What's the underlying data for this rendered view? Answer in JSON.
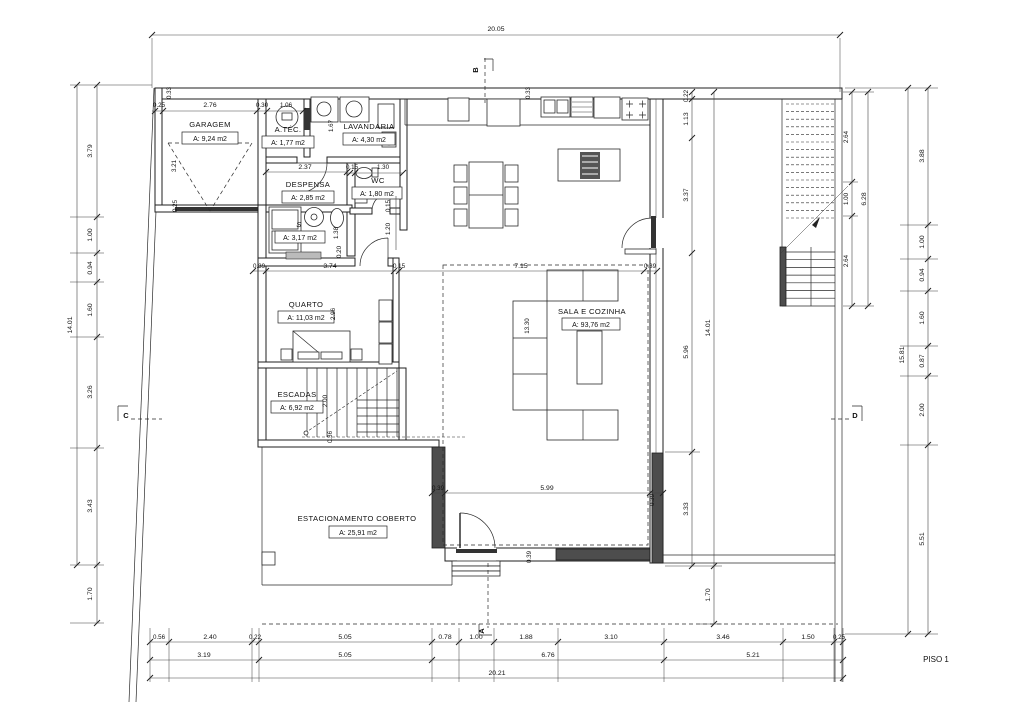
{
  "title": "PISO 1",
  "plan": {
    "rooms": {
      "garagem": {
        "name": "GARAGEM",
        "area": "A: 9,24 m2"
      },
      "atec": {
        "name": "A.TÉC.",
        "area": "A: 1,77 m2"
      },
      "lavandaria": {
        "name": "LAVANDARIA",
        "area": "A: 4,30 m2"
      },
      "despensa": {
        "name": "DESPENSA",
        "area": "A: 2,85 m2"
      },
      "wc": {
        "name": "WC",
        "area": "A: 1,80 m2"
      },
      "sanit": {
        "name": "S",
        "area": "A: 3,17 m2"
      },
      "quarto": {
        "name": "QUARTO",
        "area": "A: 11,03 m2"
      },
      "escadas": {
        "name": "ESCADAS",
        "area": "A: 6,92 m2"
      },
      "sala": {
        "name": "SALA E COZINHA",
        "area": "A: 93,76 m2"
      },
      "estacionamento": {
        "name": "ESTACIONAMENTO COBERTO",
        "area": "A: 25,91 m2"
      }
    },
    "sections": {
      "a": "A",
      "b": "B",
      "c": "C",
      "d": "D"
    }
  },
  "dims": {
    "top_overall": "20.05",
    "bottom_overall": "20.21",
    "left_overall": "14.01",
    "right_overall": "15.81",
    "left": [
      "3.79",
      "1.00",
      "0.94",
      "1.60",
      "3.26",
      "3.43",
      "1.70"
    ],
    "right": [
      "3.88",
      "1.00",
      "0.94",
      "1.60",
      "0.87",
      "2.00",
      "5.51"
    ],
    "inner_right": [
      "0.22",
      "1.13",
      "3.37",
      "5.96",
      "3.33"
    ],
    "inner_right_total": "14.01",
    "inner_right_eave": "1.70",
    "stairs": [
      "2.64",
      "1.00",
      "2.64"
    ],
    "stairs_overall": "6.28",
    "bottom1": [
      "0.56",
      "2.40",
      "0.22",
      "5.05",
      "0.78",
      "1.00",
      "1.88",
      "3.10",
      "3.46",
      "1.50",
      "0.25"
    ],
    "bottom2": [
      "3.19",
      "5.05",
      "6.76",
      "5.21"
    ],
    "top_row": [
      "0.25",
      "2.76",
      "0.30",
      "1.06"
    ],
    "garage_depth": "3.21",
    "garage_wall": "0.25",
    "wall_tl": "0.33",
    "wall_kitchen": "0.33",
    "lav_h": "1.67",
    "despensa_w": "2.37",
    "wc_row": [
      "0.15",
      "1.30"
    ],
    "hall": [
      "0.15",
      "1.20"
    ],
    "sroom": [
      "1.38",
      "0.20"
    ],
    "quarto_row": [
      "0.39",
      "3.74",
      "0.15",
      "7.15",
      "0.39"
    ],
    "quarto_h": "2.96",
    "sala_h": "13.30",
    "esc": [
      "2.00",
      "0.36"
    ],
    "sala_row": [
      "0.39",
      "5.99",
      "0.39"
    ],
    "entry_wall": "0.39"
  }
}
